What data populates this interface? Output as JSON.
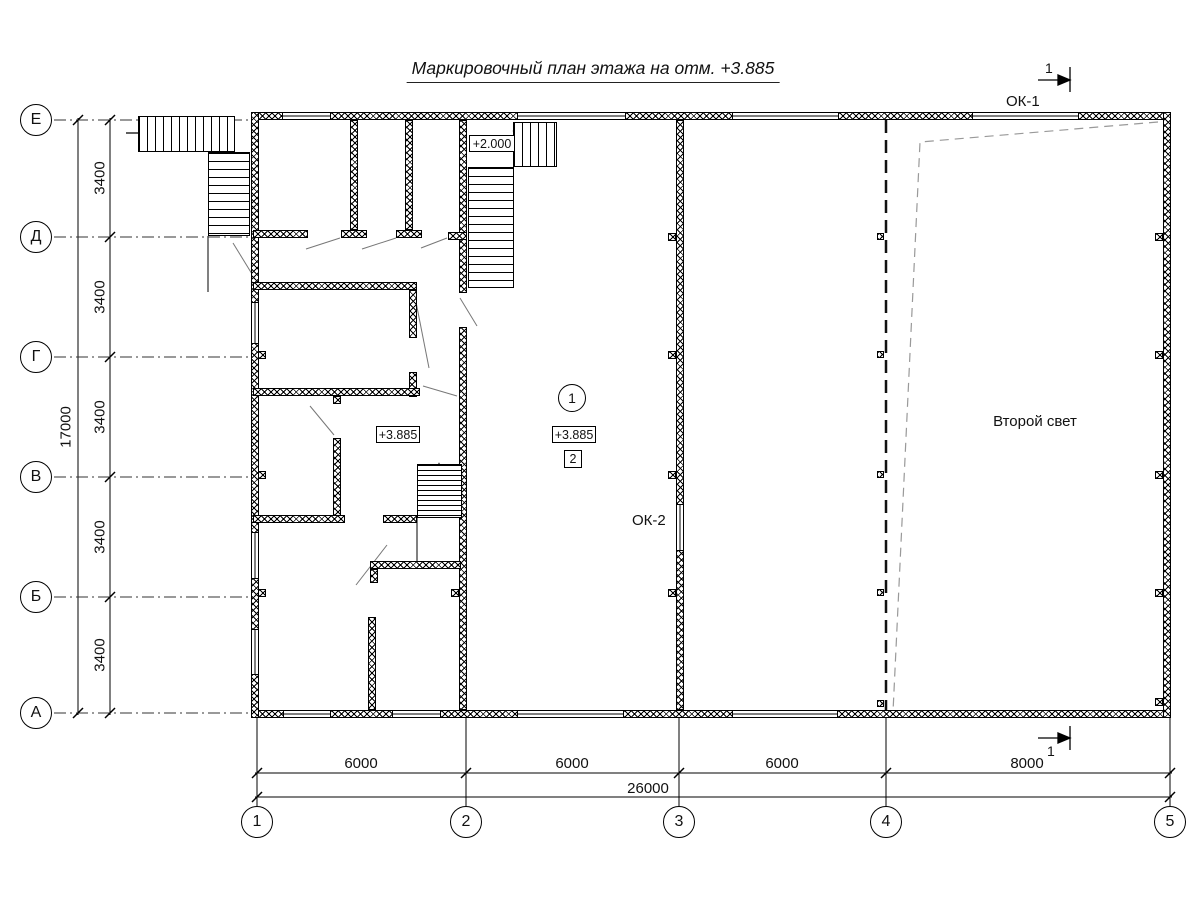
{
  "title": "Маркировочный план этажа на отм. +3.885",
  "axes": {
    "rows": [
      {
        "label": "Е"
      },
      {
        "label": "Д"
      },
      {
        "label": "Г"
      },
      {
        "label": "В"
      },
      {
        "label": "Б"
      },
      {
        "label": "А"
      }
    ],
    "cols": [
      {
        "label": "1"
      },
      {
        "label": "2"
      },
      {
        "label": "3"
      },
      {
        "label": "4"
      },
      {
        "label": "5"
      }
    ]
  },
  "dimensions": {
    "row_spacings": [
      "3400",
      "3400",
      "3400",
      "3400",
      "3400"
    ],
    "rows_total": "17000",
    "col_spacings": [
      "6000",
      "6000",
      "6000",
      "8000"
    ],
    "cols_total": "26000"
  },
  "labels": {
    "window_ok1": "ОК-1",
    "window_ok2": "ОК-2",
    "second_light": "Второй свет",
    "level_plus_2000": "+2.000",
    "level_plus_3885_left": "+3.885",
    "level_plus_3885_center": "+3.885",
    "room_number_circle": "1",
    "room_number_box": "2",
    "section_cut": "1"
  },
  "colors": {
    "line": "#000000",
    "door_swing": "#777777",
    "hidden_edge": "#999999"
  }
}
